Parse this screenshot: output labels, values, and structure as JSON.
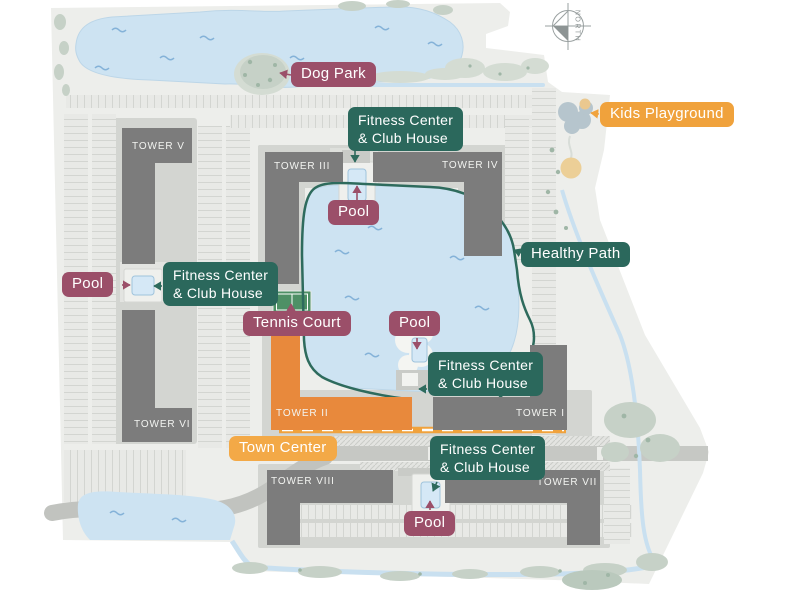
{
  "compass": {
    "label": "NORTH"
  },
  "towers": [
    {
      "id": "tower-v",
      "label": "TOWER V"
    },
    {
      "id": "tower-iii",
      "label": "TOWER III"
    },
    {
      "id": "tower-iv",
      "label": "TOWER IV"
    },
    {
      "id": "tower-vi",
      "label": "TOWER VI"
    },
    {
      "id": "tower-ii",
      "label": "TOWER II"
    },
    {
      "id": "tower-i",
      "label": "TOWER I"
    },
    {
      "id": "tower-viii",
      "label": "TOWER VIII"
    },
    {
      "id": "tower-vii",
      "label": "TOWER VII"
    }
  ],
  "badges": {
    "dog_park": "Dog Park",
    "kids_playground": "Kids Playground",
    "fitness_line1": "Fitness Center",
    "fitness_line2": "& Club House",
    "pool": "Pool",
    "healthy_path": "Healthy Path",
    "tennis_court": "Tennis Court",
    "town_center": "Town Center"
  },
  "colors": {
    "badge_purple": "#9B4F69",
    "badge_teal": "#2B685C",
    "badge_orange": "#F0A23C",
    "badge_orange_light": "#F3A947",
    "tower_ii_orange": "#E8893C",
    "building_gray": "#7C7C7C",
    "water_blue": "#CDE3F2",
    "healthy_path_teal": "#2E6B5D",
    "site_gray": "#EDEEEB"
  }
}
